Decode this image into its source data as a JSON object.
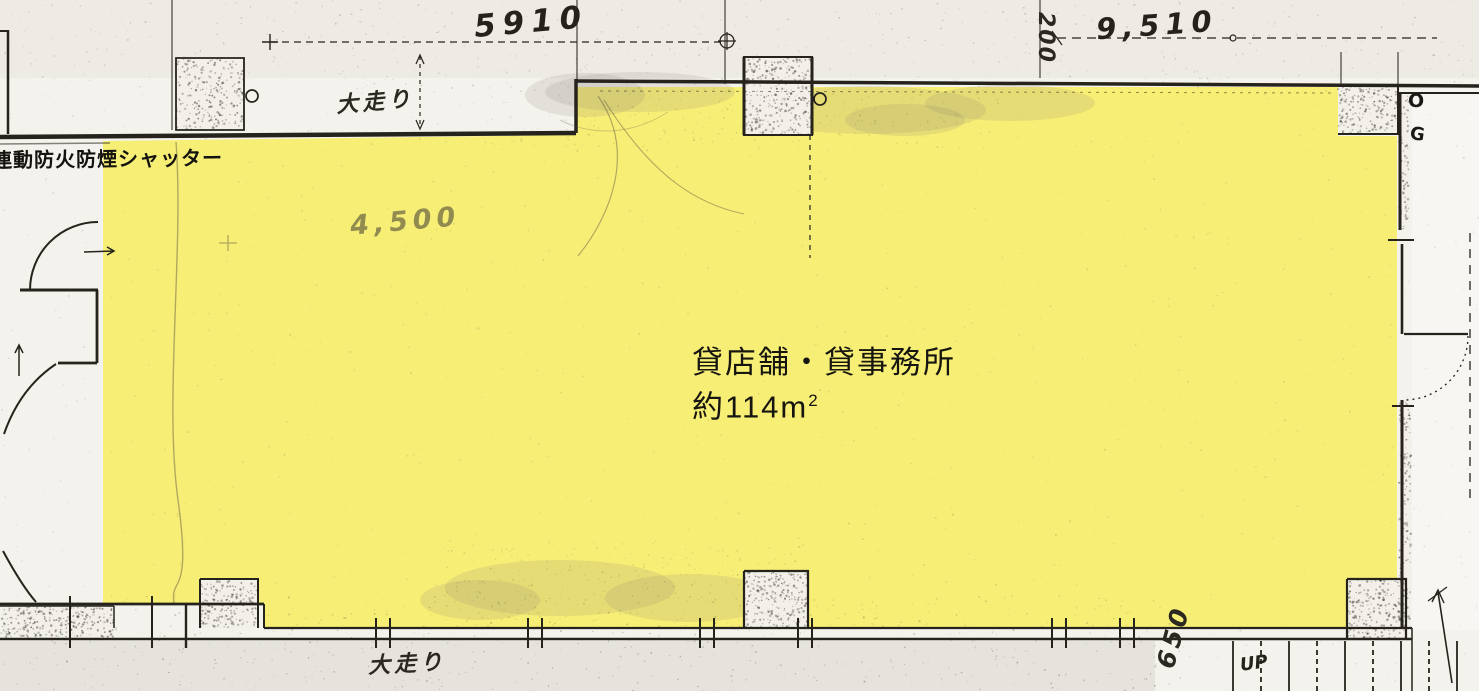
{
  "plan": {
    "room_label": {
      "line1": "貸店舗・貸事務所",
      "line2": "約114m",
      "line2_sup": "2"
    },
    "colors": {
      "highlight": "#F7EE76",
      "ink": "#26231C",
      "paper": "#F4F2EC"
    }
  },
  "dimensions": {
    "top_left": "5910",
    "top_right": "9,510",
    "top_vertical": "200",
    "interior": "4,500",
    "stair_side": "650"
  },
  "notes": {
    "shutter": "連動防火防煙シャッター",
    "corridor_top": "大走り",
    "corridor_bottom": "大走り",
    "stairs_up": "UP",
    "grid_mark_o": "O",
    "grid_mark_g": "G"
  }
}
